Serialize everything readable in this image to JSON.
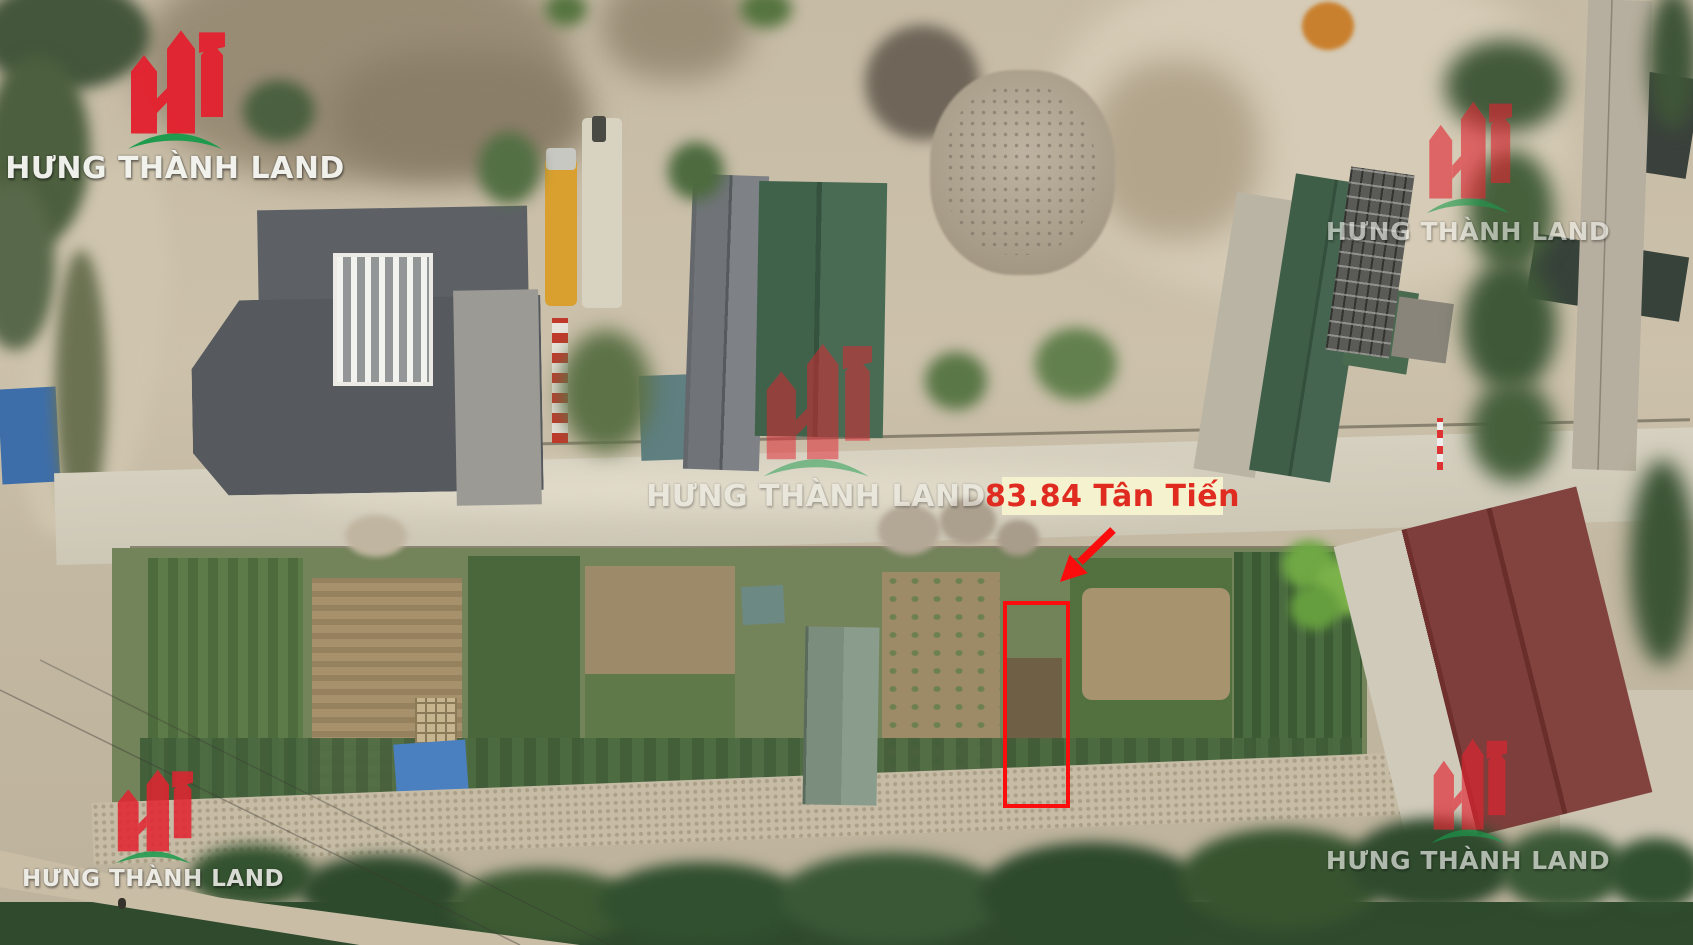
{
  "annotation": {
    "label": "83.84 Tân Tiến",
    "label_text_color": "#e02b20",
    "label_background": "#f4f2cf",
    "outline_color": "#fb0d0d",
    "arrow_color": "#fb0d0d"
  },
  "watermark": {
    "brand": "HƯNG THÀNH LAND",
    "logo_red": "#e32330",
    "swoosh_green": "#1a9b4c",
    "text_color": "#f4f4f0"
  }
}
